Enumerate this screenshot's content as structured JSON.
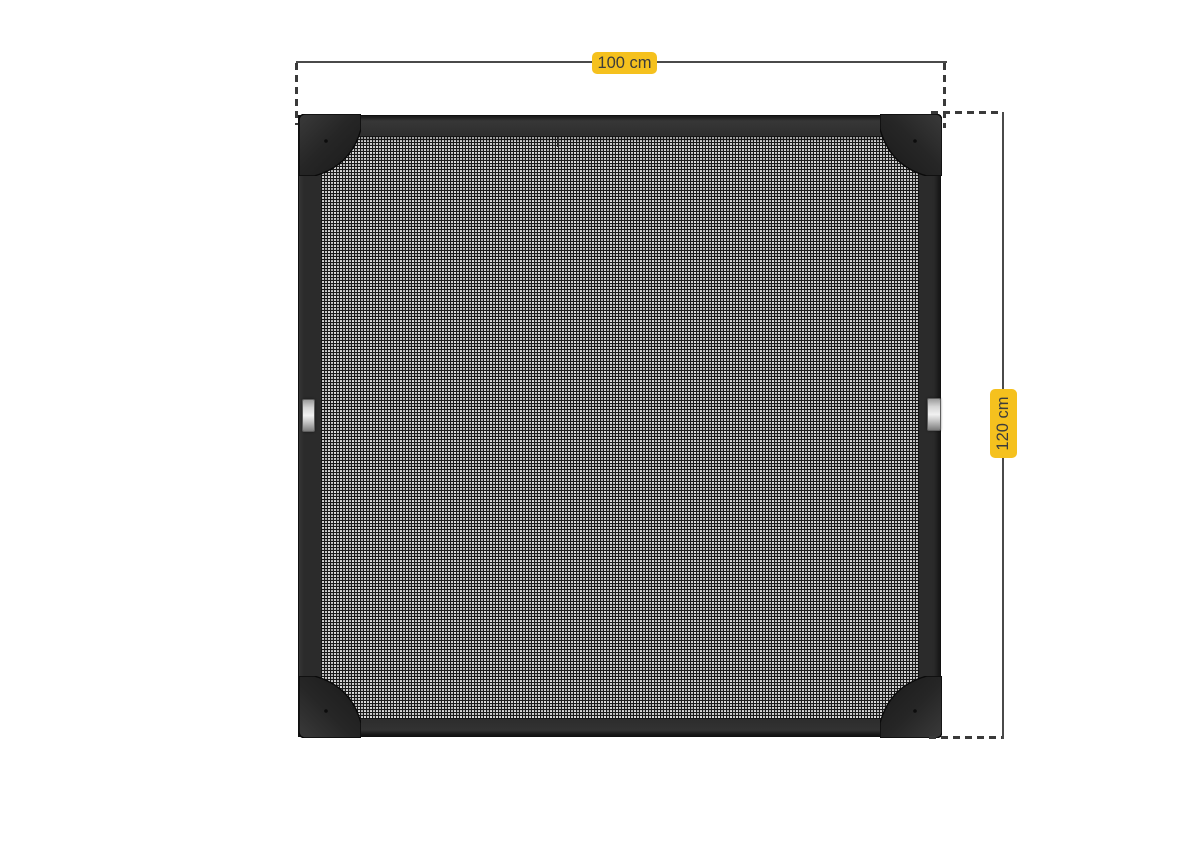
{
  "dimensions": {
    "width": {
      "label": "100 cm"
    },
    "height": {
      "label": "120 cm"
    }
  },
  "theme": {
    "page_bg": "#ffffff",
    "label_bg": "#f5c11e",
    "label_text": "#3c3c3c",
    "dim_line": "#4a4a4a",
    "dash_line": "#3a3a3a",
    "frame_body": "#2b2b2b",
    "frame_edge": "#101010",
    "corner_fill": "#262626",
    "mesh_base": "#c9c9c9",
    "mesh_grid": "#1a1a1a",
    "handle_light": "#f1f1f1",
    "handle_dark": "#9c9c9c",
    "handle_border": "#5e5e5e"
  }
}
